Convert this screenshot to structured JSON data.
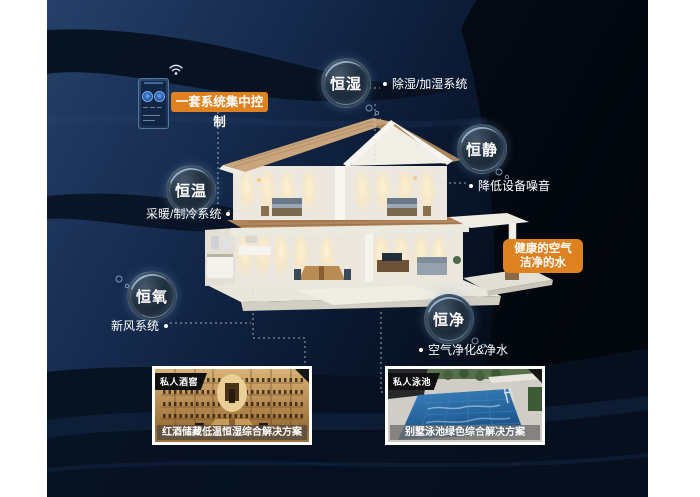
{
  "colors": {
    "accent_orange": "#de8120",
    "panel_navy": "#142847",
    "bubble_text": "#ffffff"
  },
  "control": {
    "label": "一套系统集中控制",
    "icon": "wifi-icon",
    "device": "smart-home-wall-panel"
  },
  "features": [
    {
      "id": "constant-humidity",
      "label": "恒湿",
      "note": "除湿/加湿系统"
    },
    {
      "id": "constant-quiet",
      "label": "恒静",
      "note": "降低设备噪音"
    },
    {
      "id": "constant-temperature",
      "label": "恒温",
      "note": "采暖/制冷系统"
    },
    {
      "id": "constant-oxygen",
      "label": "恒氧",
      "note": "新风系统"
    },
    {
      "id": "constant-purity",
      "label": "恒净",
      "note": "空气净化&净水"
    }
  ],
  "callout": {
    "line1": "健康的空气",
    "line2": "洁净的水"
  },
  "cards": [
    {
      "tag": "私人酒窖",
      "caption": "红酒储藏低温恒湿综合解决方案"
    },
    {
      "tag": "私人泳池",
      "caption": "别墅泳池绿色综合解决方案"
    }
  ]
}
